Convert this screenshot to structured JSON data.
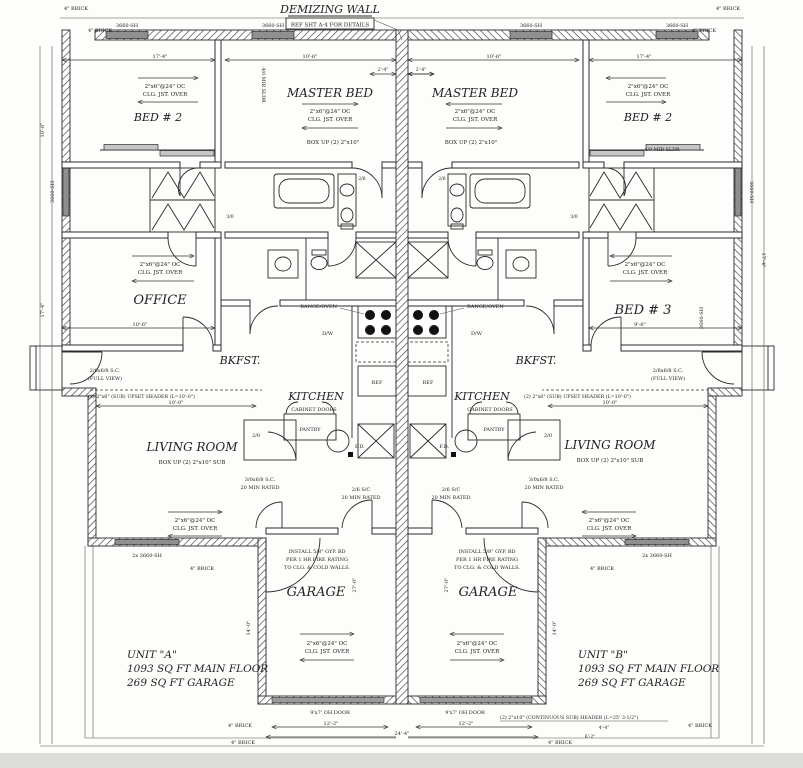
{
  "header": {
    "title": "DEMIZING WALL",
    "subtitle": "REF SHT A-4 FOR DETAILS"
  },
  "rooms": {
    "master": "MASTER BED",
    "bed2": "BED # 2",
    "bed3": "BED # 3",
    "office": "OFFICE",
    "kitchen": "KITCHEN",
    "bkfst": "BKFST.",
    "living": "LIVING ROOM",
    "garage": "GARAGE",
    "pantry": "PANTRY",
    "ref": "REF"
  },
  "notes": {
    "clg_a": "2\"x6\"@24\" OC",
    "clg_b": "CLG. JST. OVER",
    "box_up": "BOX UP (2) 2\"x10\"",
    "box_up_sub": "BOX UP (2) 2\"x10\" SUB",
    "range": "RANGE/OVEN",
    "dw": "D/W",
    "cab": "CABINET DOORS",
    "fd": "F.D.",
    "fire_a": "INSTALL 5/8\" GYP. BD",
    "fire_b": "PER 1 HR FIRE RATING",
    "fire_c": "TO CLG. & COLD WALLS.",
    "rated_a": "2/6 S/C",
    "rated_b": "20 MIN RATED",
    "rated_c": "3/0x6/8 S.C.",
    "upset": "(2) 2\"x6\" (SUB) UPSET HEADER (L=10'-0\")",
    "cont": "(2) 2\"x10\" (CONTINUOUS SUB) HEADER (L=25' 3-1/2\")",
    "oh": "9'x7' OH DOOR",
    "brick": "4\" BRICK",
    "win": "3660-SH",
    "win2": "2x 3660-SH",
    "mir": "4/0 MIR SLDR",
    "fullview_a": "2/6x6/8 S.C.",
    "fullview_b": "(FULL VIEW)"
  },
  "dims": {
    "d17_4": "17'-4\"",
    "d10_6": "10'-6\"",
    "d9_6": "9'-6\"",
    "d10_0": "10'-0\"",
    "d12_2": "12'-2\"",
    "d24_4": "24'-4\"",
    "d4_4": "4'-4\"",
    "d6_2": "6'-2\"",
    "d27_0": "27'-0\"",
    "d14_0": "14'-0\"",
    "d2_4": "2'-4\""
  },
  "doors": {
    "s2_6": "2/6",
    "s3_0": "3/0",
    "s2_0": "2/0"
  },
  "units": {
    "a": {
      "name": "UNIT \"A\"",
      "floor": "1093 SQ FT MAIN FLOOR",
      "garage": "269 SQ FT GARAGE"
    },
    "b": {
      "name": "UNIT \"B\"",
      "floor": "1093 SQ FT MAIN FLOOR",
      "garage": "269 SQ FT GARAGE"
    }
  }
}
